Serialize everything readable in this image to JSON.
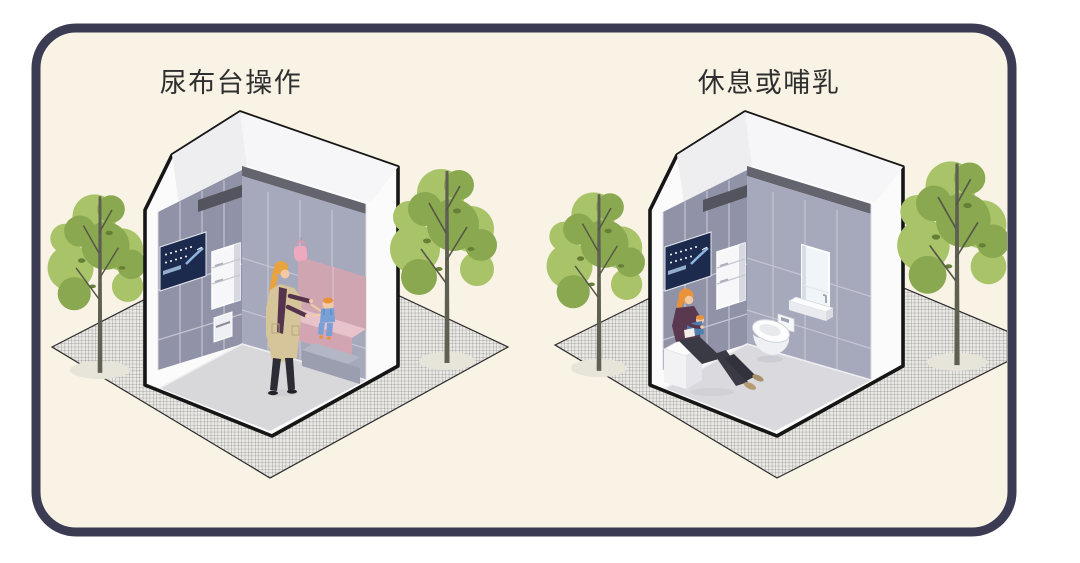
{
  "card": {
    "background": "#f8f3e5",
    "border_color": "#3b3b54"
  },
  "panels": [
    {
      "id": "left",
      "title": "尿布台操作"
    },
    {
      "id": "right",
      "title": "休息或哺乳"
    }
  ],
  "palette": {
    "page_background": "#ffffff",
    "outline_black": "#161616",
    "wall_gray_dark": "#9092a7",
    "wall_gray_light": "#a6a8bb",
    "under_roof_band": "#63646d",
    "vent_bar": "#53545d",
    "pink_wall": "#cfa5b2",
    "pink_counter_top": "#e9c3cc",
    "pink_counter_front": "#d3a5b2",
    "hanging_bag_pink": "#efa9bf",
    "screen_navy": "#1c2b4d",
    "screen_accent_blue": "#8fb4e0",
    "floor_gray": "#d8d8db",
    "ground_hatch_base": "#ebe9e5",
    "tree_green_light": "#a9c468",
    "tree_green_mid": "#8aa850",
    "tree_green_dark": "#657f37",
    "tree_trunk": "#5f6052",
    "hair_orange": "#e8a33e",
    "coat_tan": "#d6c49a",
    "top_purple": "#54344c",
    "pants_dark": "#2c2c35",
    "baby_blue": "#78a0d6",
    "skin": "#f2cba6",
    "white_fixture": "#fdfdfe"
  }
}
